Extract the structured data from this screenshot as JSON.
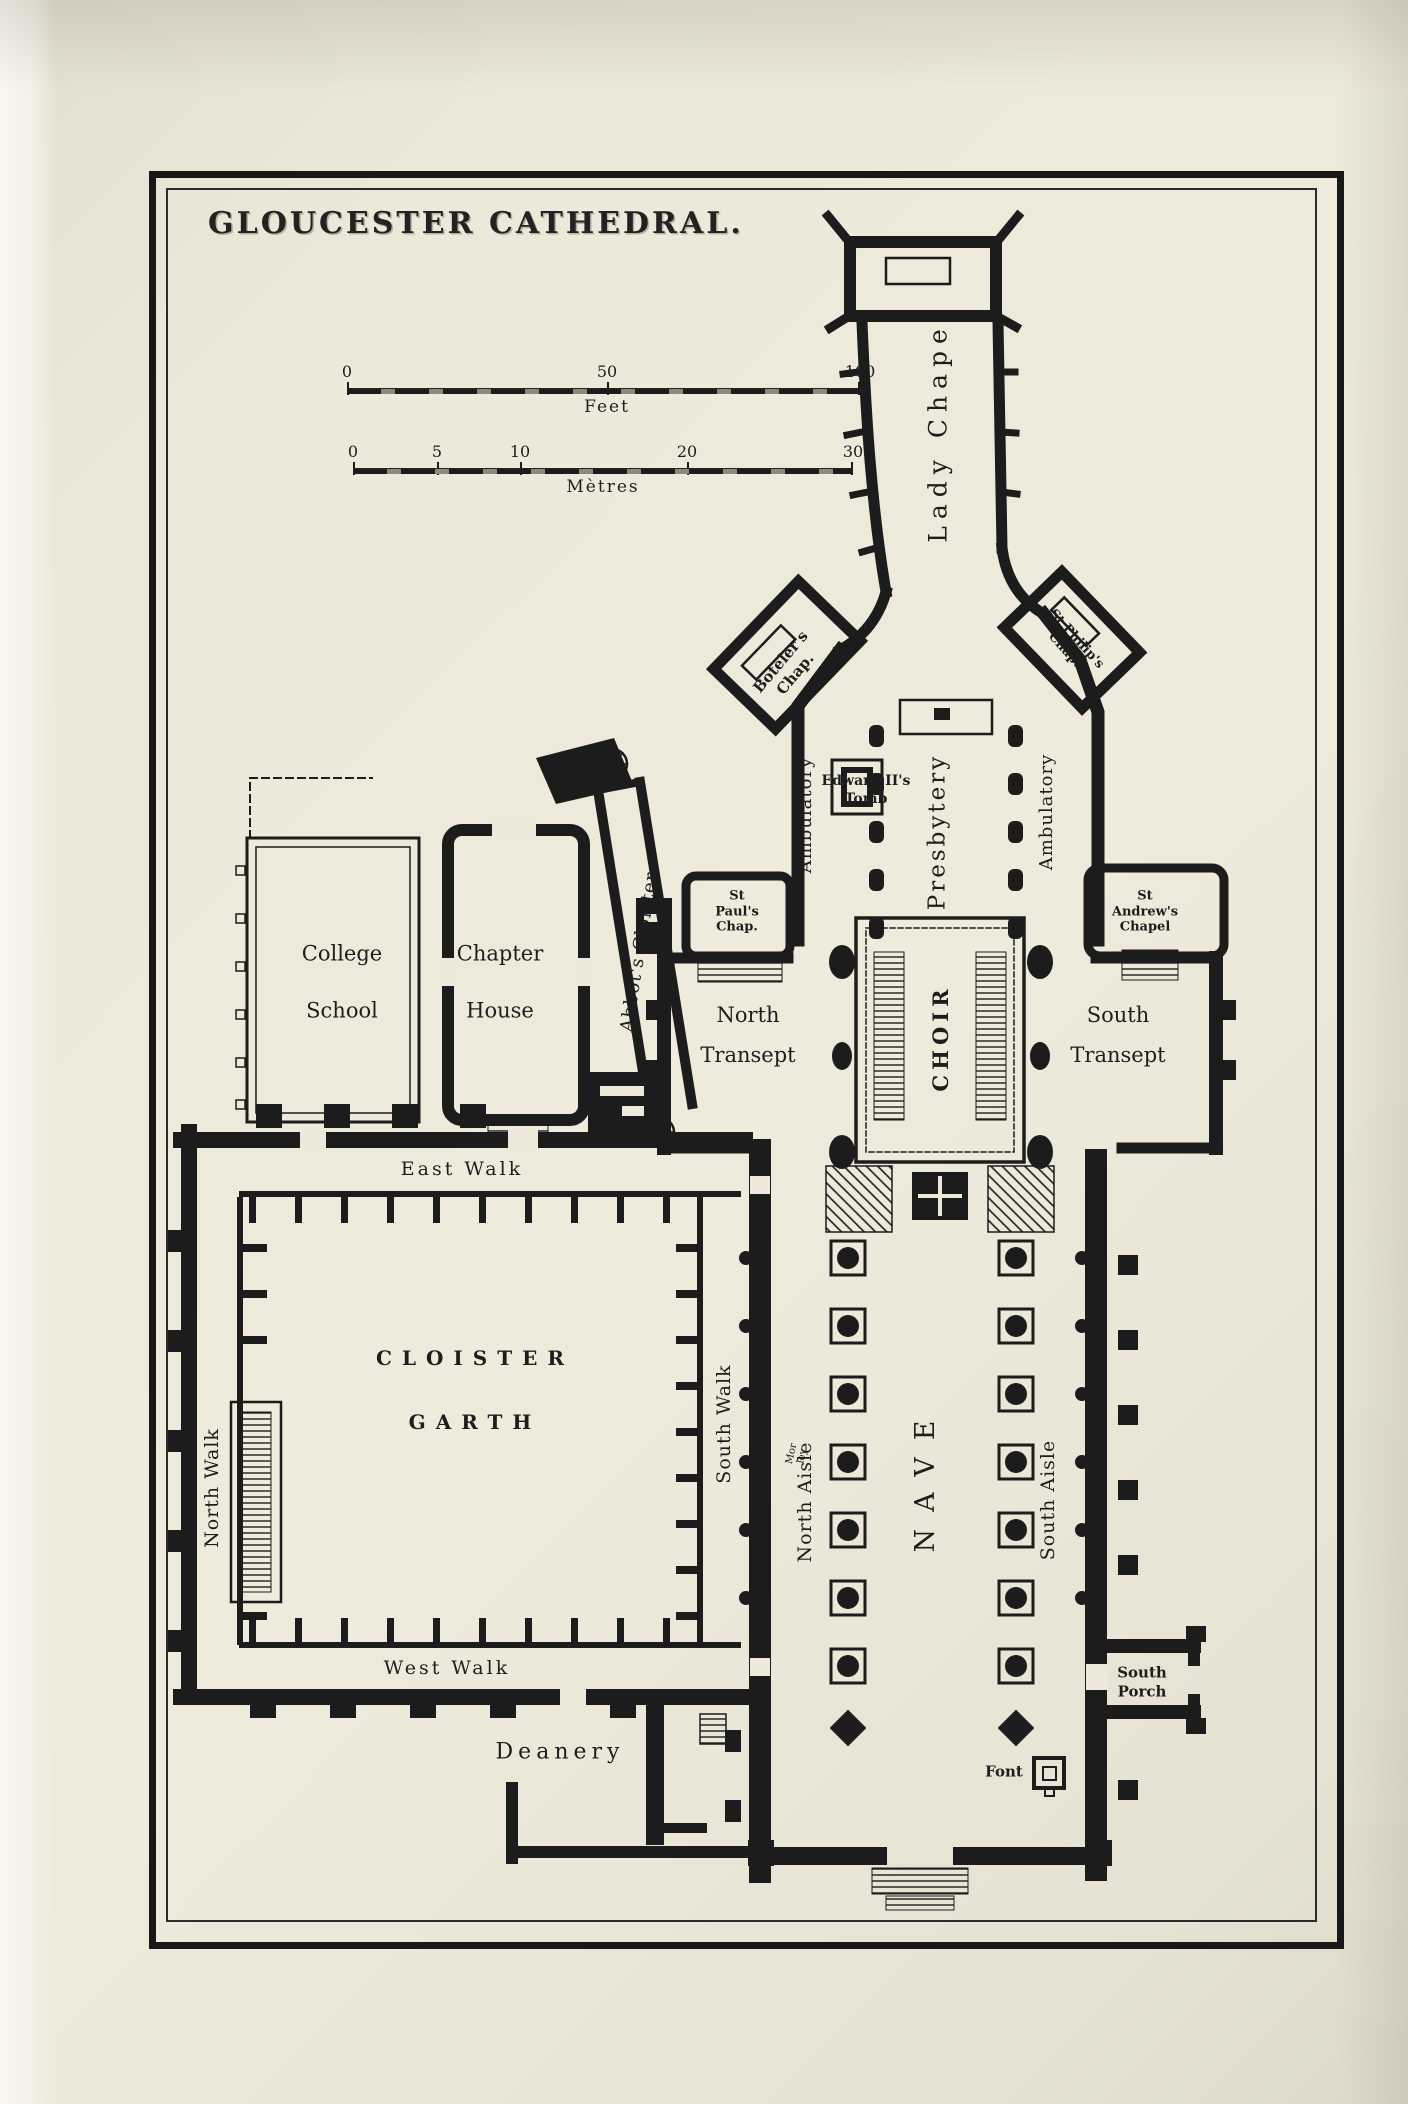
{
  "title": "GLOUCESTER CATHEDRAL.",
  "scale_bars": {
    "feet": {
      "unit": "Feet",
      "ticks": [
        "0",
        "50",
        "100"
      ]
    },
    "metres": {
      "unit": "Mètres",
      "ticks": [
        "0",
        "5",
        "10",
        "20",
        "30"
      ]
    }
  },
  "labels": {
    "lady_chapel": "Lady Chapel",
    "botelers_chapel": "Boteler's\nChap.",
    "st_philips_chapel": "St Philip's\nChap.",
    "ambulatory_left": "Ambulatory",
    "ambulatory_right": "Ambulatory",
    "edward_ii_tomb": "Edward II's\nTomb",
    "presbytery": "Presbytery",
    "st_pauls_chapel": "St\nPaul's\nChap.",
    "st_andrews_chapel": "St\nAndrew's\nChapel",
    "north_transept": "North\nTransept",
    "south_transept": "South\nTransept",
    "choir": "CHOIR",
    "college_school": "College\nSchool",
    "chapter_house": "Chapter\nHouse",
    "abbots_cloister": "Abbot's Cloister",
    "east_walk": "East Walk",
    "north_walk": "North Walk",
    "south_walk": "South Walk",
    "west_walk": "West Walk",
    "cloister_garth": "CLOISTER\nGARTH",
    "north_aisle": "North Aisle",
    "nave": "NAVE",
    "south_aisle": "South Aisle",
    "morley": "Mor\nley",
    "deanery": "Deanery",
    "south_porch": "South\nPorch",
    "font": "Font"
  },
  "colors": {
    "paper": "#ece8da",
    "ink": "#1c1c1c"
  }
}
